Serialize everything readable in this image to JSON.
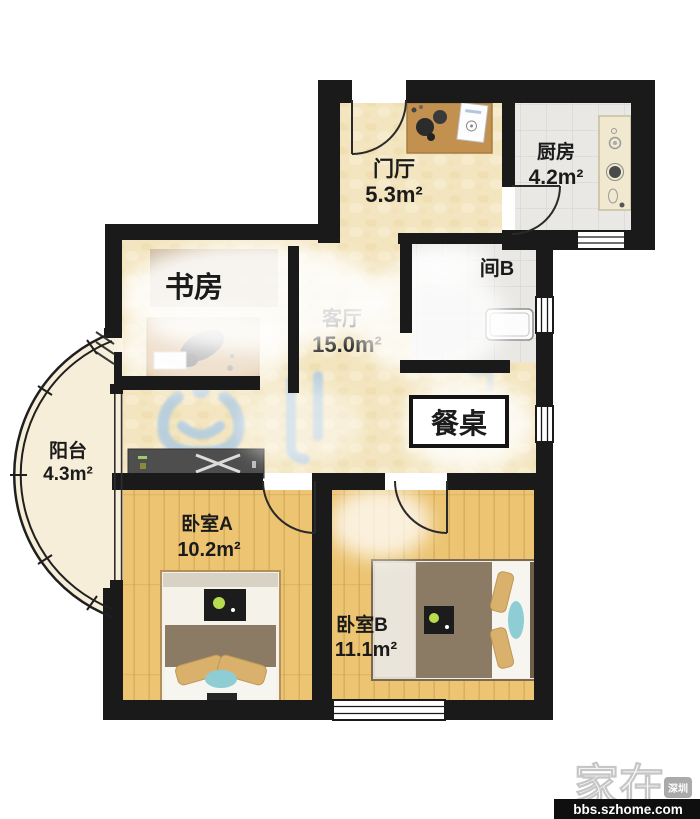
{
  "rooms": [
    {
      "id": "entry-hall",
      "name": "门厅",
      "area": "5.3m²"
    },
    {
      "id": "kitchen",
      "name": "厨房",
      "area": "4.2m²"
    },
    {
      "id": "study",
      "name": "书房",
      "area": ""
    },
    {
      "id": "living-room",
      "name": "客厅",
      "area": "15.0m²"
    },
    {
      "id": "bathroom-b",
      "name": "间B",
      "area": ""
    },
    {
      "id": "balcony",
      "name": "阳台",
      "area": "4.3m²"
    },
    {
      "id": "bedroom-a",
      "name": "卧室A",
      "area": "10.2m²"
    },
    {
      "id": "bedroom-b",
      "name": "卧室B",
      "area": "11.1m²"
    }
  ],
  "labels": {
    "dining_table": "餐桌"
  },
  "watermark": {
    "brand": "家在",
    "badge": "深圳",
    "url": "bbs.szhome.com"
  },
  "colors": {
    "wall": "#1a1a1a",
    "floor_beige": "#f3e5bf",
    "floor_wood": "#ecc472",
    "floor_tile": "#e9e8e5",
    "balcony_floor": "#f6eed8",
    "watermark_blue": "#a5c7e8",
    "bed_teal": "#8ecdd4",
    "furniture_wood": "#c2904f",
    "blanket_brown": "#8b7b64",
    "dining_box_border": "#141414"
  }
}
